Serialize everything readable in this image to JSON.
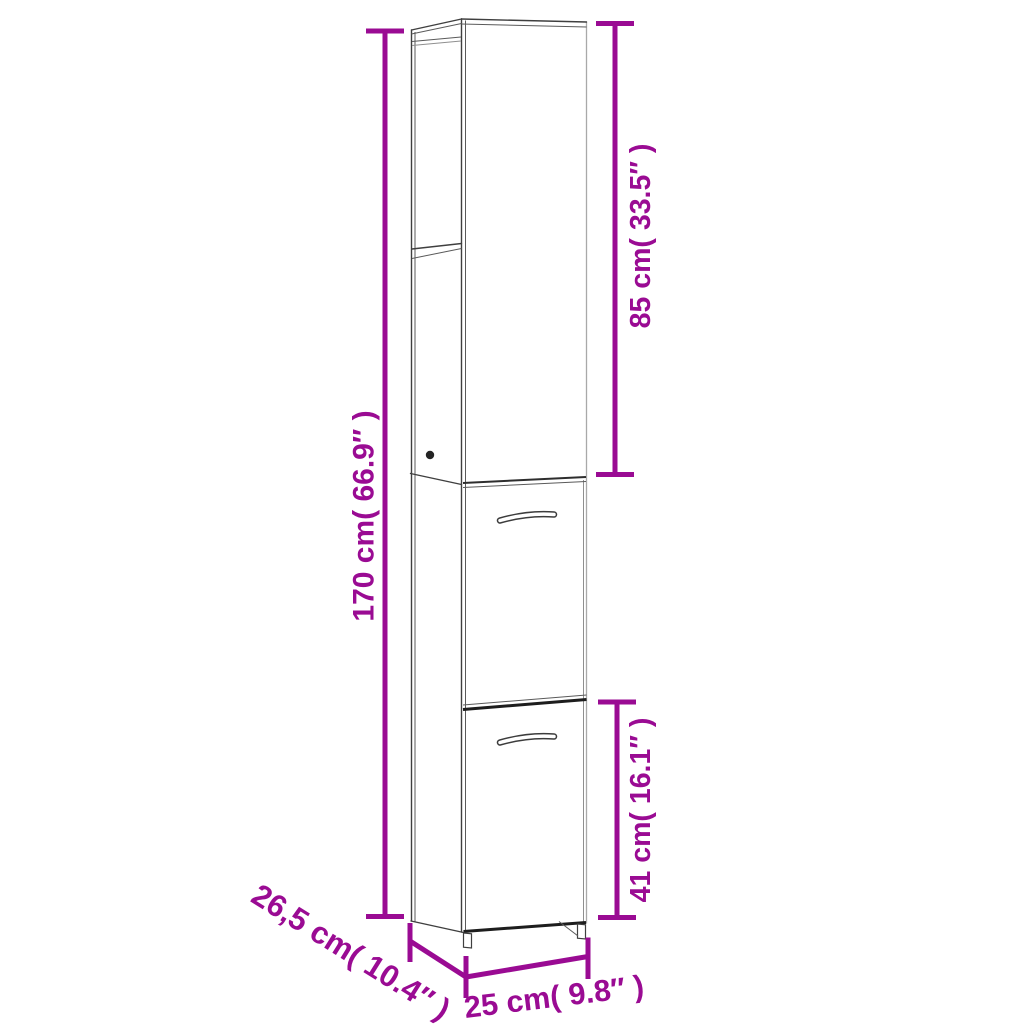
{
  "colors": {
    "accent": "#9A0B93",
    "drawing_line": "#3F3F3F",
    "background": "#FFFFFF"
  },
  "diagram": {
    "kind": "furniture-dimension-diagram",
    "dimensions": {
      "total_height": {
        "cm": "170",
        "inches": "66.9",
        "label": "170 cm( 66.9″ )"
      },
      "upper_section_height": {
        "cm": "85",
        "inches": "33.5",
        "label": "85 cm( 33.5″ )"
      },
      "lower_door_height": {
        "cm": "41",
        "inches": "16.1",
        "label": "41 cm( 16.1″ )"
      },
      "depth": {
        "cm": "26,5",
        "inches": "10.4",
        "label": "26,5 cm( 10.4″ )"
      },
      "width": {
        "cm": "25",
        "inches": "9.8",
        "label": "25 cm( 9.8″ )"
      }
    }
  }
}
